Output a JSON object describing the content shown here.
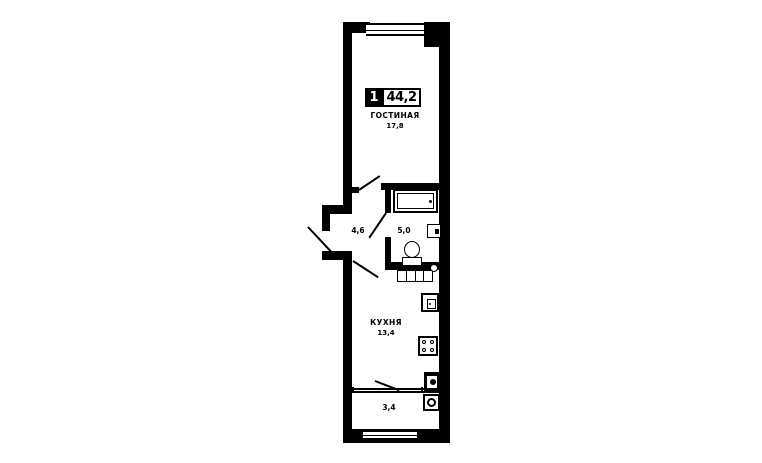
{
  "plan": {
    "badge": {
      "room_count": "1",
      "total_area": "44,2"
    },
    "rooms": {
      "living": {
        "name": "ГОСТИНАЯ",
        "area": "17,8"
      },
      "hall": {
        "area": "4,6"
      },
      "bathroom": {
        "area": "5,0"
      },
      "kitchen": {
        "name": "КУХНЯ",
        "area": "13,4"
      },
      "balcony": {
        "area": "3,4"
      }
    },
    "colors": {
      "wall": "#000000",
      "background": "#ffffff"
    },
    "fixtures": [
      "bathtub",
      "wash-basin",
      "toilet",
      "kitchen-counter",
      "counter-sink",
      "kitchen-sink-unit",
      "stove",
      "vent-shaft",
      "washing-machine",
      "entry-door",
      "interior-doors",
      "windows"
    ]
  }
}
